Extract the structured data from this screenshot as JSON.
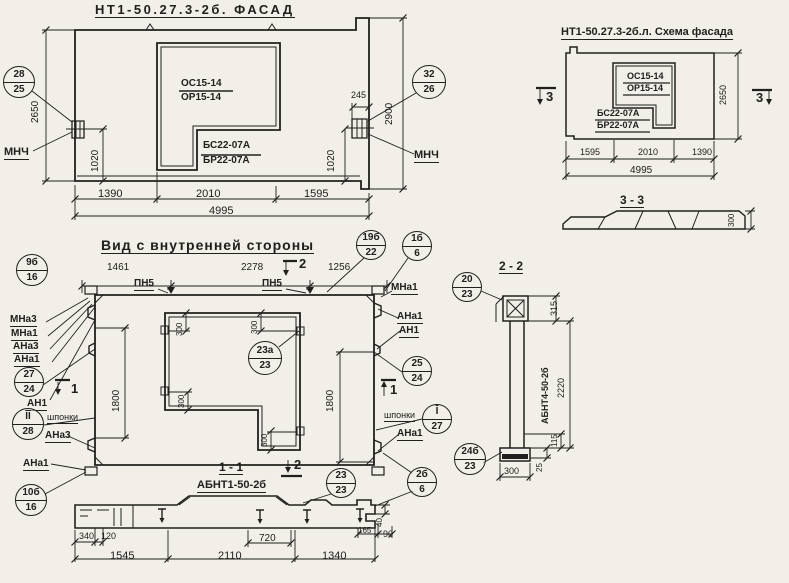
{
  "page": {
    "kind": "scanned structural precast panel working drawing"
  },
  "colors": {
    "paper": "#f1efe8",
    "ink": "#20201e"
  },
  "labels": [
    {
      "name": "facade-title",
      "text": "НТ1-50.27.3-2б. ФАСАД",
      "x": 95,
      "y": 3,
      "size": 13,
      "bold": 1,
      "u": 1,
      "ls": 2.5
    },
    {
      "name": "facade-window-mark-top",
      "text": "ОС15-14",
      "x": 181,
      "y": 79,
      "size": 10,
      "bold": 1
    },
    {
      "name": "facade-window-mark-bottom",
      "text": "ОР15-14",
      "x": 181,
      "y": 93,
      "size": 10,
      "bold": 1
    },
    {
      "name": "facade-sill-mark-top",
      "text": "БС22-07А",
      "x": 203,
      "y": 141,
      "size": 10,
      "bold": 1
    },
    {
      "name": "facade-sill-mark-bottom",
      "text": "БР22-07А",
      "x": 203,
      "y": 156,
      "size": 10,
      "bold": 1
    },
    {
      "name": "facade-insert-label-left",
      "text": "МНЧ",
      "x": 4,
      "y": 147,
      "size": 11,
      "bold": 1,
      "u": 1
    },
    {
      "name": "facade-insert-label-right",
      "text": "МНЧ",
      "x": 414,
      "y": 150,
      "size": 11,
      "bold": 1,
      "u": 1
    },
    {
      "name": "facade-dim-2650",
      "text": "2650",
      "x": 31,
      "y": 123,
      "size": 10,
      "rot": 1
    },
    {
      "name": "facade-dim-1020-left",
      "text": "1020",
      "x": 91,
      "y": 172,
      "size": 10,
      "rot": 1
    },
    {
      "name": "facade-dim-1020-right",
      "text": "1020",
      "x": 327,
      "y": 172,
      "size": 10,
      "rot": 1
    },
    {
      "name": "facade-dim-245",
      "text": "245",
      "x": 351,
      "y": 91,
      "size": 9
    },
    {
      "name": "facade-dim-2900",
      "text": "2900",
      "x": 385,
      "y": 125,
      "size": 10,
      "rot": 1
    },
    {
      "name": "facade-dim-1390",
      "text": "1390",
      "x": 98,
      "y": 189,
      "size": 11
    },
    {
      "name": "facade-dim-2010",
      "text": "2010",
      "x": 196,
      "y": 189,
      "size": 11
    },
    {
      "name": "facade-dim-1595",
      "text": "1595",
      "x": 304,
      "y": 189,
      "size": 11
    },
    {
      "name": "facade-dim-4995",
      "text": "4995",
      "x": 209,
      "y": 206,
      "size": 11
    },
    {
      "name": "schema-title",
      "text": "НТ1-50.27.3-2б.л. Схема фасада",
      "x": 561,
      "y": 27,
      "size": 11,
      "bold": 1,
      "u": 1
    },
    {
      "name": "schema-window-mark-top",
      "text": "ОС15-14",
      "x": 627,
      "y": 72,
      "size": 9,
      "bold": 1
    },
    {
      "name": "schema-window-mark-bottom",
      "text": "ОР15-14",
      "x": 627,
      "y": 84,
      "size": 9,
      "bold": 1
    },
    {
      "name": "schema-sill-mark-top",
      "text": "БС22-07А",
      "x": 597,
      "y": 109,
      "size": 9,
      "bold": 1
    },
    {
      "name": "schema-sill-mark-bottom",
      "text": "БР22-07А",
      "x": 597,
      "y": 121,
      "size": 9,
      "bold": 1
    },
    {
      "name": "section3-marker-left",
      "text": "3",
      "x": 546,
      "y": 90,
      "size": 13,
      "bold": 1
    },
    {
      "name": "section3-marker-right",
      "text": "3",
      "x": 756,
      "y": 91,
      "size": 13,
      "bold": 1
    },
    {
      "name": "schema-dim-2650",
      "text": "2650",
      "x": 719,
      "y": 105,
      "size": 9,
      "rot": 1
    },
    {
      "name": "schema-dim-1595",
      "text": "1595",
      "x": 580,
      "y": 148,
      "size": 9
    },
    {
      "name": "schema-dim-2010",
      "text": "2010",
      "x": 638,
      "y": 148,
      "size": 9
    },
    {
      "name": "schema-dim-1390",
      "text": "1390",
      "x": 692,
      "y": 148,
      "size": 9
    },
    {
      "name": "schema-dim-4995",
      "text": "4995",
      "x": 630,
      "y": 166,
      "size": 10
    },
    {
      "name": "section33-title",
      "text": "3 - 3",
      "x": 620,
      "y": 194,
      "size": 12,
      "bold": 1,
      "u": 1
    },
    {
      "name": "section33-dim-300",
      "text": "300",
      "x": 728,
      "y": 227,
      "size": 8,
      "rot": 1
    },
    {
      "name": "inner-view-title",
      "text": "Вид с внутренней стороны",
      "x": 101,
      "y": 238,
      "size": 14,
      "bold": 1,
      "u": 1,
      "ls": 1
    },
    {
      "name": "inner-dim-1461",
      "text": "1461",
      "x": 107,
      "y": 263,
      "size": 10
    },
    {
      "name": "inner-dim-2278",
      "text": "2278",
      "x": 241,
      "y": 263,
      "size": 10
    },
    {
      "name": "inner-dim-1256",
      "text": "1256",
      "x": 328,
      "y": 263,
      "size": 10
    },
    {
      "name": "pn5-label-left",
      "text": "ПН5",
      "x": 134,
      "y": 279,
      "size": 10,
      "bold": 1,
      "u": 1
    },
    {
      "name": "pn5-label-right",
      "text": "ПН5",
      "x": 262,
      "y": 279,
      "size": 10,
      "bold": 1,
      "u": 1
    },
    {
      "name": "section2-marker-top",
      "text": "2",
      "x": 299,
      "y": 257,
      "size": 13,
      "bold": 1
    },
    {
      "name": "mna1-label-top-right",
      "text": "МНа1",
      "x": 391,
      "y": 283,
      "size": 10,
      "bold": 1,
      "u": 1
    },
    {
      "name": "mna3-label-left",
      "text": "МНа3",
      "x": 10,
      "y": 315,
      "size": 10,
      "bold": 1,
      "u": 1
    },
    {
      "name": "mna1-label-left",
      "text": "МНа1",
      "x": 11,
      "y": 329,
      "size": 10,
      "bold": 1,
      "u": 1
    },
    {
      "name": "ana3-label-left",
      "text": "АНа3",
      "x": 13,
      "y": 342,
      "size": 10,
      "bold": 1,
      "u": 1
    },
    {
      "name": "ana1-label-left",
      "text": "АНа1",
      "x": 14,
      "y": 355,
      "size": 10,
      "bold": 1,
      "u": 1
    },
    {
      "name": "an1-label-left",
      "text": "АН1",
      "x": 27,
      "y": 399,
      "size": 10,
      "bold": 1,
      "u": 1
    },
    {
      "name": "section1-marker-left",
      "text": "1",
      "x": 71,
      "y": 382,
      "size": 13,
      "bold": 1
    },
    {
      "name": "shponki-label-left",
      "text": "шпонки",
      "x": 47,
      "y": 413,
      "size": 9,
      "u": 1
    },
    {
      "name": "ana3-label-left-2",
      "text": "АНа3",
      "x": 45,
      "y": 431,
      "size": 10,
      "bold": 1,
      "u": 1
    },
    {
      "name": "ana1-label-left-2",
      "text": "АНа1",
      "x": 23,
      "y": 459,
      "size": 10,
      "bold": 1,
      "u": 1
    },
    {
      "name": "inner-dim-1800-left",
      "text": "1800",
      "x": 112,
      "y": 412,
      "size": 10,
      "rot": 1
    },
    {
      "name": "inner-dim-1800-right",
      "text": "1800",
      "x": 326,
      "y": 412,
      "size": 10,
      "rot": 1
    },
    {
      "name": "inner-dim-300-tl",
      "text": "300",
      "x": 176,
      "y": 336,
      "size": 8,
      "rot": 1
    },
    {
      "name": "inner-dim-300-tr",
      "text": "300",
      "x": 251,
      "y": 334,
      "size": 8,
      "rot": 1
    },
    {
      "name": "inner-dim-300-ml",
      "text": "300",
      "x": 178,
      "y": 408,
      "size": 8,
      "rot": 1
    },
    {
      "name": "inner-dim-300-bl",
      "text": "300",
      "x": 261,
      "y": 447,
      "size": 8,
      "rot": 1
    },
    {
      "name": "ana1-label-right",
      "text": "АНа1",
      "x": 397,
      "y": 312,
      "size": 10,
      "bold": 1,
      "u": 1
    },
    {
      "name": "an1-label-right",
      "text": "АН1",
      "x": 399,
      "y": 326,
      "size": 10,
      "bold": 1,
      "u": 1
    },
    {
      "name": "section1-marker-right",
      "text": "1",
      "x": 390,
      "y": 383,
      "size": 13,
      "bold": 1
    },
    {
      "name": "shponki-label-right",
      "text": "шпонки",
      "x": 384,
      "y": 411,
      "size": 9,
      "u": 1
    },
    {
      "name": "ana1-label-right-2",
      "text": "АНа1",
      "x": 397,
      "y": 429,
      "size": 10,
      "bold": 1,
      "u": 1
    },
    {
      "name": "section11-title",
      "text": "1 - 1",
      "x": 219,
      "y": 461,
      "size": 12,
      "bold": 1,
      "u": 1
    },
    {
      "name": "section2-marker-bottom",
      "text": "2",
      "x": 294,
      "y": 458,
      "size": 13,
      "bold": 1
    },
    {
      "name": "abnt1-label",
      "text": "АБНТ1-50-2б",
      "x": 197,
      "y": 480,
      "size": 11,
      "bold": 1,
      "u": 1
    },
    {
      "name": "s11-dim-340",
      "text": "340",
      "x": 79,
      "y": 532,
      "size": 9
    },
    {
      "name": "s11-dim-120",
      "text": "120",
      "x": 101,
      "y": 532,
      "size": 9
    },
    {
      "name": "s11-dim-1545",
      "text": "1545",
      "x": 110,
      "y": 551,
      "size": 11
    },
    {
      "name": "s11-dim-720",
      "text": "720",
      "x": 259,
      "y": 534,
      "size": 10
    },
    {
      "name": "s11-dim-2110",
      "text": "2110",
      "x": 218,
      "y": 551,
      "size": 11
    },
    {
      "name": "s11-dim-1340",
      "text": "1340",
      "x": 322,
      "y": 551,
      "size": 11
    },
    {
      "name": "s11-dim-165",
      "text": "165",
      "x": 358,
      "y": 527,
      "size": 8
    },
    {
      "name": "s11-dim-90",
      "text": "90",
      "x": 383,
      "y": 530,
      "size": 9
    },
    {
      "name": "s11-dim-40",
      "text": "40",
      "x": 376,
      "y": 527,
      "size": 8,
      "rot": 1
    },
    {
      "name": "section22-title",
      "text": "2 - 2",
      "x": 499,
      "y": 260,
      "size": 12,
      "bold": 1,
      "u": 1
    },
    {
      "name": "abnt4-label",
      "text": "АБНТ4-50-2б",
      "x": 541,
      "y": 424,
      "size": 9,
      "bold": 1,
      "rot": 1
    },
    {
      "name": "s22-dim-315",
      "text": "315",
      "x": 550,
      "y": 316,
      "size": 9,
      "rot": 1
    },
    {
      "name": "s22-dim-2220",
      "text": "2220",
      "x": 557,
      "y": 398,
      "size": 9,
      "rot": 1
    },
    {
      "name": "s22-dim-115",
      "text": "115",
      "x": 551,
      "y": 447,
      "size": 8,
      "rot": 1
    },
    {
      "name": "s22-dim-25",
      "text": "25",
      "x": 536,
      "y": 472,
      "size": 8,
      "rot": 1
    },
    {
      "name": "s22-dim-300",
      "text": "300",
      "x": 504,
      "y": 467,
      "size": 9
    }
  ],
  "callouts": [
    {
      "name": "callout-28-25",
      "top": "28",
      "bottom": "25",
      "cx": 19,
      "cy": 82,
      "r": 16
    },
    {
      "name": "callout-32-26",
      "top": "32",
      "bottom": "26",
      "cx": 429,
      "cy": 82,
      "r": 17
    },
    {
      "name": "callout-19b-22",
      "top": "19б",
      "bottom": "22",
      "cx": 371,
      "cy": 245,
      "r": 15
    },
    {
      "name": "callout-1b-6",
      "top": "1б",
      "bottom": "6",
      "cx": 417,
      "cy": 246,
      "r": 15
    },
    {
      "name": "callout-9b-16",
      "top": "9б",
      "bottom": "16",
      "cx": 32,
      "cy": 270,
      "r": 16
    },
    {
      "name": "callout-27-24",
      "top": "27",
      "bottom": "24",
      "cx": 29,
      "cy": 382,
      "r": 15
    },
    {
      "name": "callout-II-28",
      "top": "II",
      "bottom": "28",
      "cx": 28,
      "cy": 424,
      "r": 16,
      "ol": 1
    },
    {
      "name": "callout-10b-16",
      "top": "10б",
      "bottom": "16",
      "cx": 31,
      "cy": 500,
      "r": 16
    },
    {
      "name": "callout-25-24",
      "top": "25",
      "bottom": "24",
      "cx": 417,
      "cy": 371,
      "r": 15
    },
    {
      "name": "callout-I-27",
      "top": "I",
      "bottom": "27",
      "cx": 437,
      "cy": 419,
      "r": 15,
      "ol": 1
    },
    {
      "name": "callout-20-23",
      "top": "20",
      "bottom": "23",
      "cx": 467,
      "cy": 287,
      "r": 15
    },
    {
      "name": "callout-24b-23",
      "top": "24б",
      "bottom": "23",
      "cx": 470,
      "cy": 459,
      "r": 16
    },
    {
      "name": "callout-2b-6",
      "top": "2б",
      "bottom": "6",
      "cx": 422,
      "cy": 482,
      "r": 15
    },
    {
      "name": "callout-23a-23",
      "top": "23а",
      "bottom": "23",
      "cx": 265,
      "cy": 358,
      "r": 17
    },
    {
      "name": "callout-23-23",
      "top": "23",
      "bottom": "23",
      "cx": 341,
      "cy": 483,
      "r": 15
    }
  ]
}
